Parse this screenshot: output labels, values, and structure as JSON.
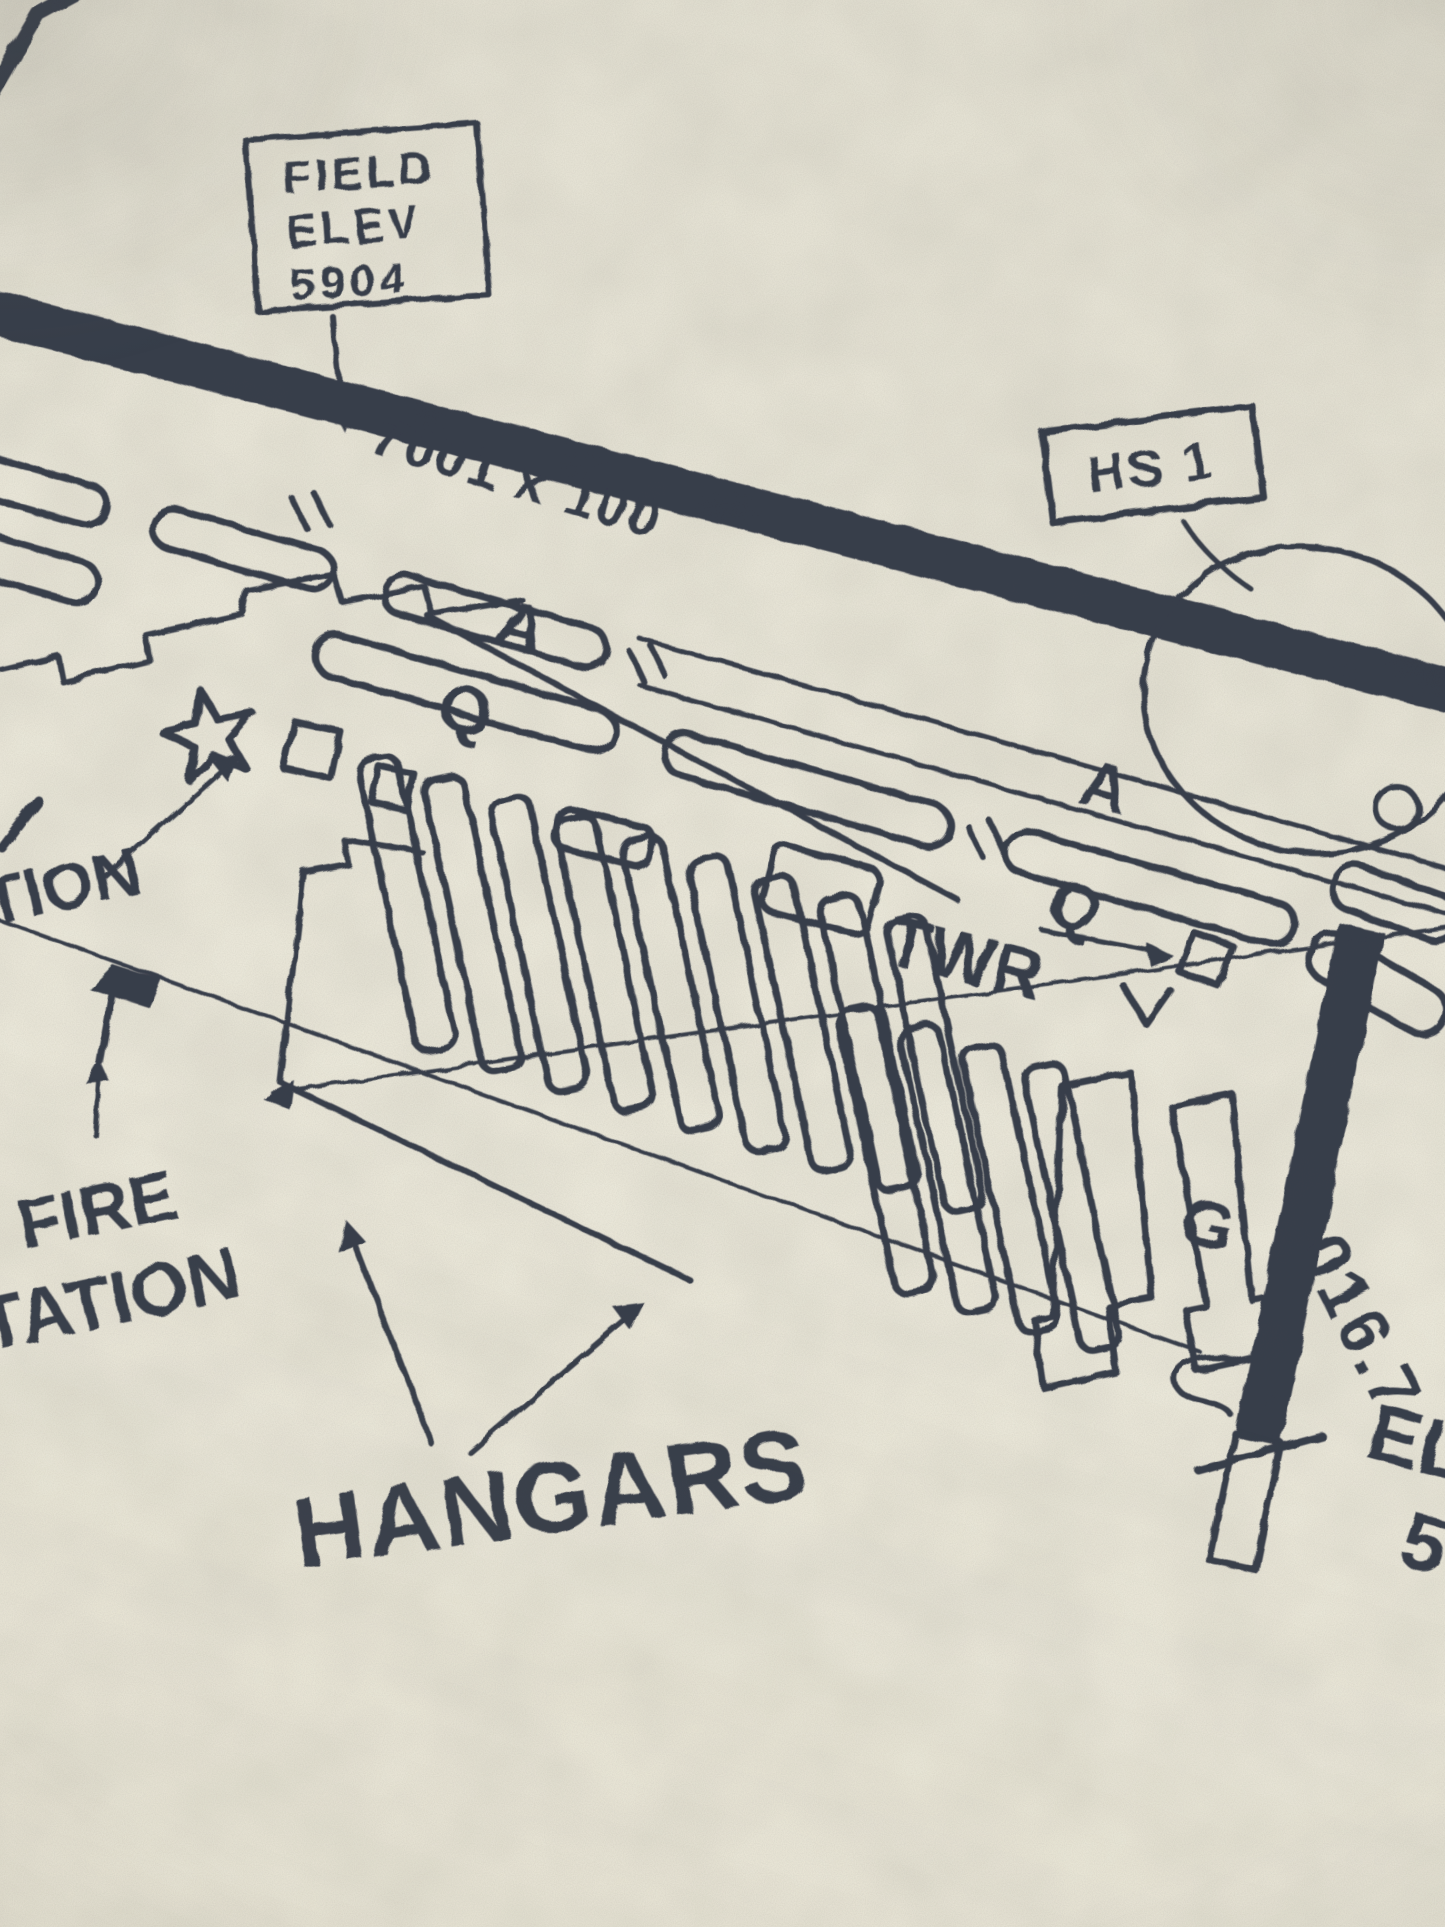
{
  "colors": {
    "paper": "#e9e6d8",
    "ink": "#2b3040"
  },
  "labels": {
    "field_elev_line1": "FIELD",
    "field_elev_line2": "ELEV",
    "field_elev_line3": "5904",
    "runway_dimensions": "7001 x 100",
    "hotspot": "HS 1",
    "tower": "TWR",
    "taxiway_a_1": "A",
    "taxiway_q_1": "Q",
    "taxiway_a_2": "A",
    "taxiway_q_2": "Q",
    "taxiway_g": "G",
    "fire_station_line1": "FIRE",
    "fire_station_line2": "TATION",
    "hangars": "HANGARS",
    "left_edge_fragment": "TION",
    "runway_heading": "016.7",
    "right_edge_fragment_elev": "EL",
    "right_edge_fragment_number": "5"
  }
}
